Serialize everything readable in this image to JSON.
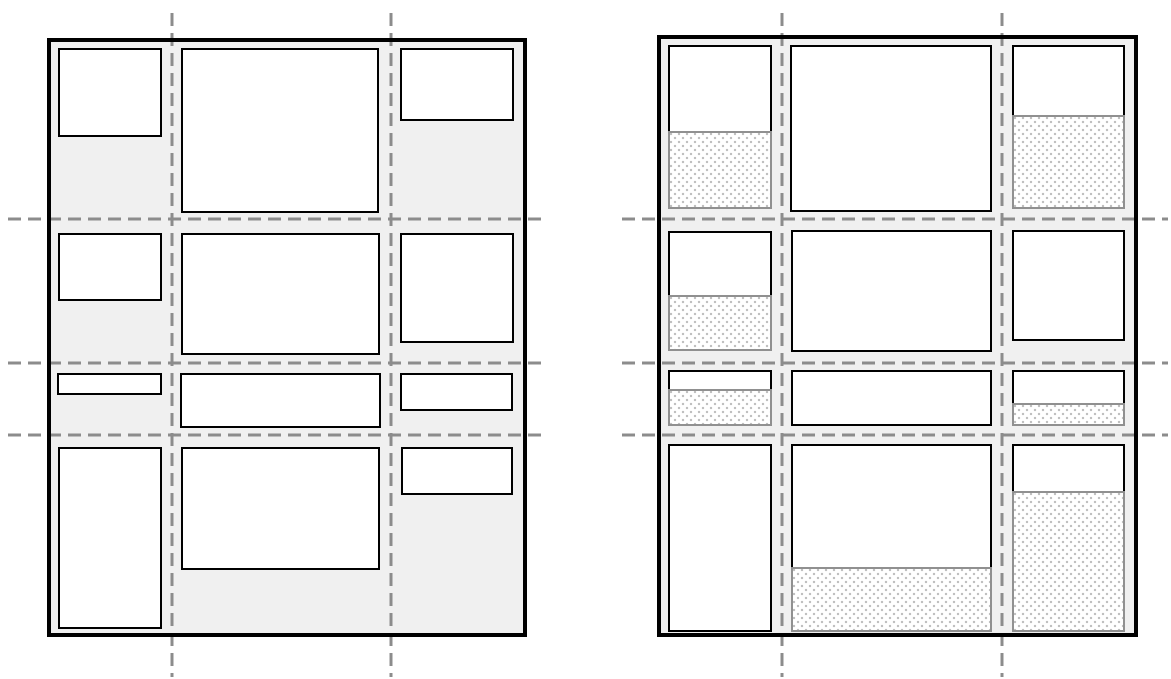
{
  "canvas": {
    "width": 1171,
    "height": 679,
    "background": "#ffffff"
  },
  "colors": {
    "container_fill": "#f0f0f0",
    "container_border": "#000000",
    "item_fill": "#ffffff",
    "item_border": "#000000",
    "gridline": "#8c8c8c",
    "area_border": "#909090",
    "area_fill": "#ffffff",
    "area_dot": "#bdbdbd"
  },
  "gridline_style": {
    "stroke_width": 3,
    "dash": "13,7"
  },
  "item_border_width": 2.5,
  "area_border_width": 2,
  "panels": [
    {
      "name": "grid-content-sized",
      "container": {
        "x": 47,
        "y": 38,
        "w": 480,
        "h": 599,
        "border_width": 4
      },
      "v_gridlines": [
        {
          "x": 172,
          "y1": 13,
          "y2": 677
        },
        {
          "x": 391,
          "y1": 13,
          "y2": 677
        }
      ],
      "h_gridlines": [
        {
          "y": 219,
          "x1": 8,
          "x2": 546
        },
        {
          "y": 363,
          "x1": 8,
          "x2": 546
        },
        {
          "y": 435,
          "x1": 8,
          "x2": 546
        }
      ],
      "items": [
        {
          "row": 1,
          "col": 1,
          "x": 58,
          "y": 48,
          "w": 104,
          "h": 89
        },
        {
          "row": 1,
          "col": 2,
          "x": 181,
          "y": 48,
          "w": 198,
          "h": 165
        },
        {
          "row": 1,
          "col": 3,
          "x": 400,
          "y": 48,
          "w": 114,
          "h": 73
        },
        {
          "row": 2,
          "col": 1,
          "x": 58,
          "y": 233,
          "w": 104,
          "h": 68
        },
        {
          "row": 2,
          "col": 2,
          "x": 181,
          "y": 233,
          "w": 199,
          "h": 122
        },
        {
          "row": 2,
          "col": 3,
          "x": 400,
          "y": 233,
          "w": 114,
          "h": 110
        },
        {
          "row": 3,
          "col": 1,
          "x": 57,
          "y": 373,
          "w": 105,
          "h": 22
        },
        {
          "row": 3,
          "col": 2,
          "x": 180,
          "y": 373,
          "w": 201,
          "h": 55
        },
        {
          "row": 3,
          "col": 3,
          "x": 400,
          "y": 373,
          "w": 113,
          "h": 38
        },
        {
          "row": 4,
          "col": 1,
          "x": 58,
          "y": 447,
          "w": 104,
          "h": 182
        },
        {
          "row": 4,
          "col": 2,
          "x": 181,
          "y": 447,
          "w": 199,
          "h": 123
        },
        {
          "row": 4,
          "col": 3,
          "x": 401,
          "y": 447,
          "w": 112,
          "h": 48
        }
      ],
      "areas": []
    },
    {
      "name": "grid-area-sized",
      "container": {
        "x": 657,
        "y": 35,
        "w": 481,
        "h": 602,
        "border_width": 4
      },
      "v_gridlines": [
        {
          "x": 782,
          "y1": 13,
          "y2": 677
        },
        {
          "x": 1002,
          "y1": 13,
          "y2": 677
        }
      ],
      "h_gridlines": [
        {
          "y": 219,
          "x1": 622,
          "x2": 1168
        },
        {
          "y": 363,
          "x1": 622,
          "x2": 1168
        },
        {
          "y": 435,
          "x1": 622,
          "x2": 1168
        }
      ],
      "items": [
        {
          "row": 1,
          "col": 1,
          "x": 668,
          "y": 45,
          "w": 104,
          "h": 88
        },
        {
          "row": 1,
          "col": 2,
          "x": 790,
          "y": 45,
          "w": 202,
          "h": 167
        },
        {
          "row": 1,
          "col": 3,
          "x": 1012,
          "y": 45,
          "w": 113,
          "h": 72
        },
        {
          "row": 2,
          "col": 1,
          "x": 668,
          "y": 231,
          "w": 104,
          "h": 66
        },
        {
          "row": 2,
          "col": 2,
          "x": 791,
          "y": 230,
          "w": 201,
          "h": 122
        },
        {
          "row": 2,
          "col": 3,
          "x": 1012,
          "y": 230,
          "w": 113,
          "h": 111
        },
        {
          "row": 3,
          "col": 1,
          "x": 668,
          "y": 370,
          "w": 104,
          "h": 21
        },
        {
          "row": 3,
          "col": 2,
          "x": 791,
          "y": 370,
          "w": 201,
          "h": 56
        },
        {
          "row": 3,
          "col": 3,
          "x": 1012,
          "y": 370,
          "w": 113,
          "h": 35
        },
        {
          "row": 4,
          "col": 1,
          "x": 668,
          "y": 444,
          "w": 104,
          "h": 188
        },
        {
          "row": 4,
          "col": 2,
          "x": 791,
          "y": 444,
          "w": 201,
          "h": 125
        },
        {
          "row": 4,
          "col": 3,
          "x": 1012,
          "y": 444,
          "w": 113,
          "h": 49
        }
      ],
      "areas": [
        {
          "row": 1,
          "col": 1,
          "x": 668,
          "y": 131,
          "w": 104,
          "h": 78
        },
        {
          "row": 1,
          "col": 3,
          "x": 1012,
          "y": 115,
          "w": 113,
          "h": 94
        },
        {
          "row": 2,
          "col": 1,
          "x": 668,
          "y": 295,
          "w": 104,
          "h": 56
        },
        {
          "row": 3,
          "col": 1,
          "x": 668,
          "y": 389,
          "w": 104,
          "h": 37
        },
        {
          "row": 3,
          "col": 3,
          "x": 1012,
          "y": 403,
          "w": 113,
          "h": 23
        },
        {
          "row": 4,
          "col": 2,
          "x": 791,
          "y": 567,
          "w": 201,
          "h": 65
        },
        {
          "row": 4,
          "col": 3,
          "x": 1012,
          "y": 491,
          "w": 113,
          "h": 141
        }
      ]
    }
  ]
}
